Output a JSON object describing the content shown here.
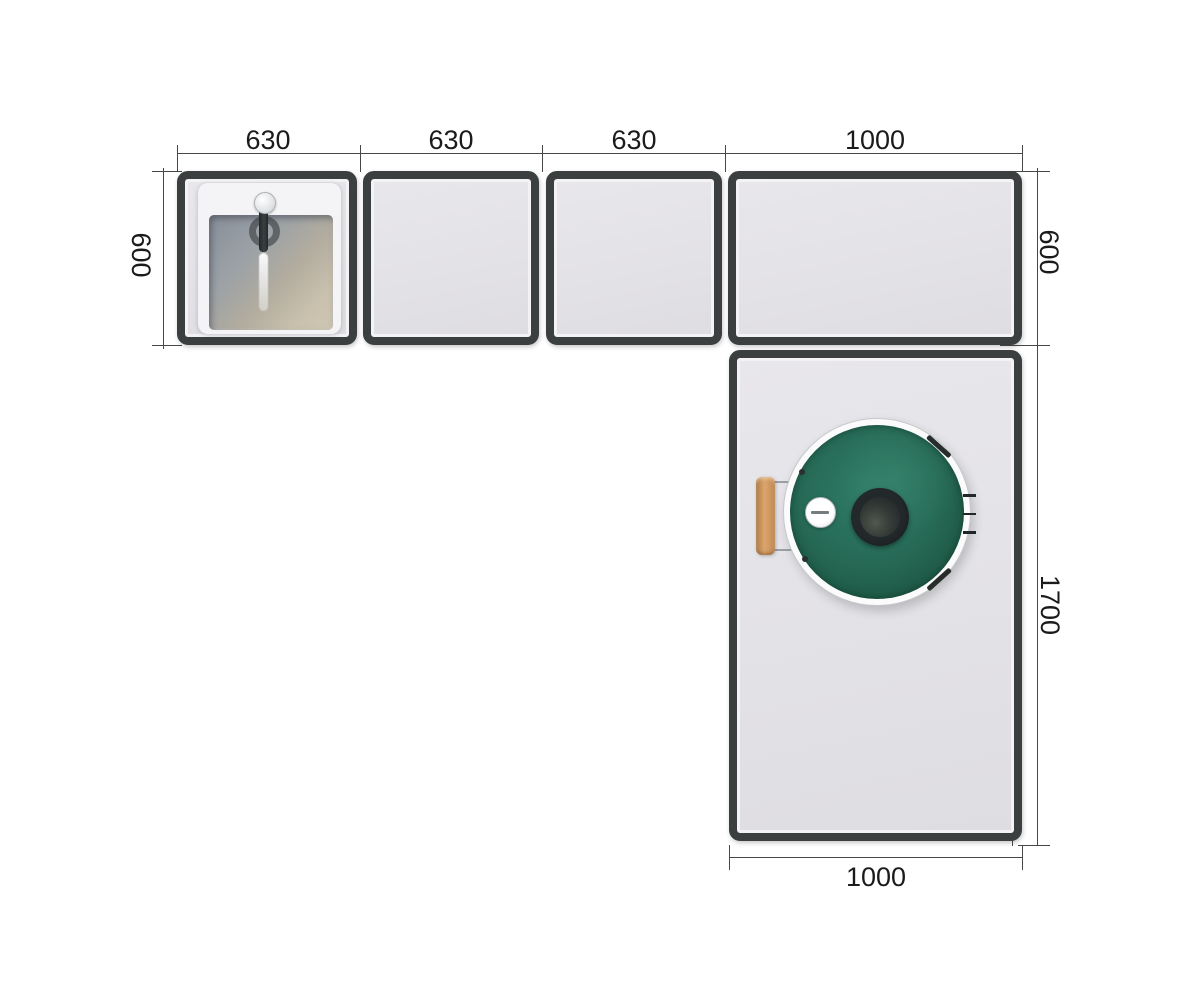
{
  "drawing": {
    "type": "plan-view-technical-drawing",
    "dim_labels": {
      "top": [
        "630",
        "630",
        "630",
        "1000"
      ],
      "left_depth": "600",
      "right_depth": "600",
      "right_length": "1700",
      "bottom_width": "1000"
    },
    "modules": [
      {
        "id": "module-1",
        "width": "630",
        "depth": "600",
        "feature": "sink-with-faucet"
      },
      {
        "id": "module-2",
        "width": "630",
        "depth": "600",
        "feature": "empty-worktop"
      },
      {
        "id": "module-3",
        "width": "630",
        "depth": "600",
        "feature": "empty-worktop"
      },
      {
        "id": "module-4",
        "width": "1000",
        "depth": "600",
        "feature": "empty-worktop"
      },
      {
        "id": "module-5",
        "width": "1000",
        "length": "1700",
        "feature": "kamado-grill"
      }
    ]
  },
  "colors": {
    "background": "#ffffff",
    "frame": "#3b3f40",
    "module_fill": "#e4e3e7",
    "dim_line": "#474747",
    "dim_text": "#1b1b1b",
    "grill_green": "#266a56",
    "grill_rim": "#fbfbfc",
    "vent_dark": "#14191b",
    "thermometer_face": "#ffffff",
    "wood_handle": "#dba56d",
    "sink_tray": "#f4f4f6",
    "sink_basin_gray": "#878e98",
    "sink_basin_beige": "#c9c1ad"
  }
}
